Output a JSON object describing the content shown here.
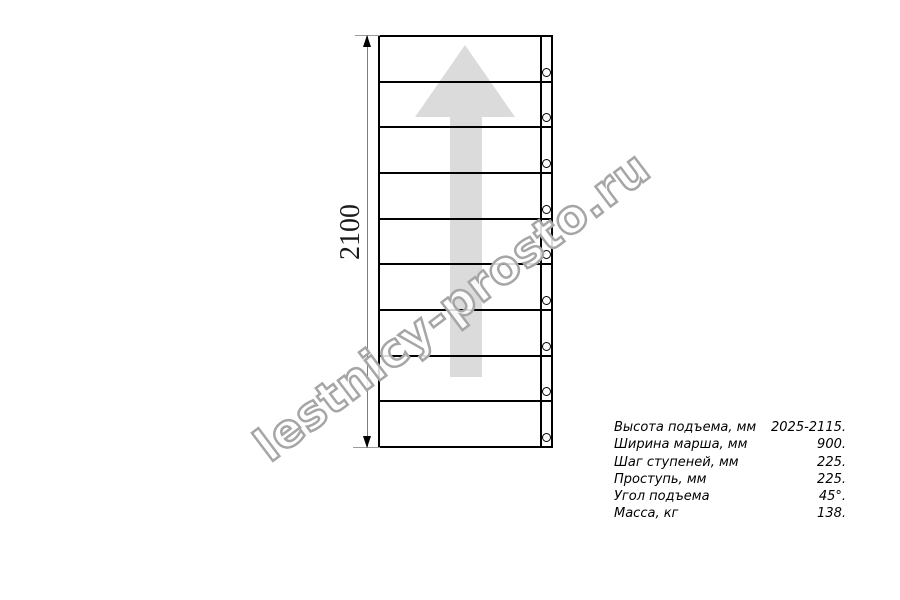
{
  "diagram": {
    "type": "staircase-plan-drawing",
    "dimension_label": "2100",
    "steps_count": 9,
    "direction": "up",
    "colors": {
      "line": "#000000",
      "arrow_fill": "#dbdbdb",
      "dim_line": "#7d7d7d",
      "watermark_outline": "#a6a6a6"
    }
  },
  "watermark": {
    "text": "lestnicy-prosto.ru"
  },
  "specs": {
    "rows": [
      {
        "label": "Высота подъема, мм",
        "value": "2025-2115."
      },
      {
        "label": "Ширина марша, мм",
        "value": "900."
      },
      {
        "label": "Шаг ступеней, мм",
        "value": "225."
      },
      {
        "label": "Проступь, мм",
        "value": "225."
      },
      {
        "label": "Угол подъема",
        "value": "45°."
      },
      {
        "label": "Масса, кг",
        "value": "138."
      }
    ]
  }
}
